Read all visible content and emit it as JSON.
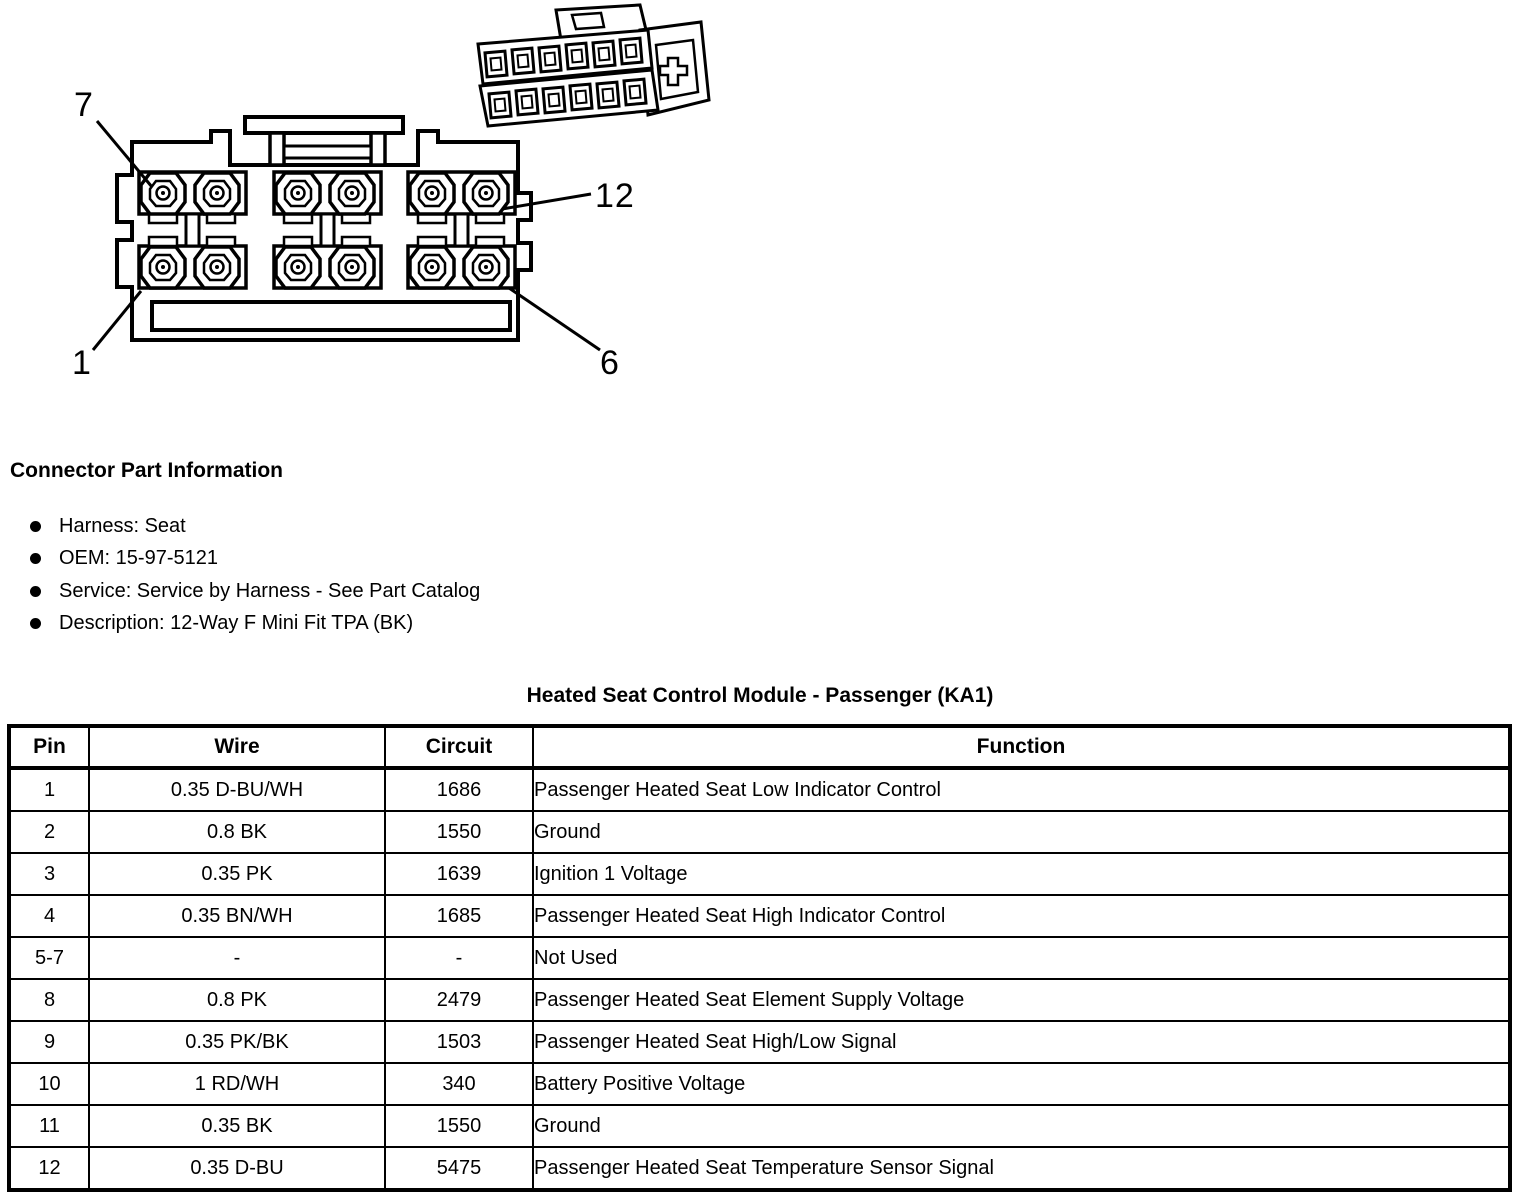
{
  "diagram": {
    "callouts": [
      {
        "id": "pin-7",
        "label": "7"
      },
      {
        "id": "pin-12",
        "label": "12"
      },
      {
        "id": "pin-1",
        "label": "1"
      },
      {
        "id": "pin-6",
        "label": "6"
      }
    ]
  },
  "section": {
    "title": "Connector Part Information",
    "bullets": [
      "Harness: Seat",
      "OEM: 15-97-5121",
      "Service: Service by Harness - See Part Catalog",
      "Description: 12-Way F Mini Fit TPA (BK)"
    ]
  },
  "table": {
    "title": "Heated Seat Control Module - Passenger (KA1)",
    "headers": [
      "Pin",
      "Wire",
      "Circuit",
      "Function"
    ],
    "rows": [
      [
        "1",
        "0.35 D-BU/WH",
        "1686",
        "Passenger Heated Seat Low Indicator Control"
      ],
      [
        "2",
        "0.8 BK",
        "1550",
        "Ground"
      ],
      [
        "3",
        "0.35 PK",
        "1639",
        "Ignition 1 Voltage"
      ],
      [
        "4",
        "0.35 BN/WH",
        "1685",
        "Passenger Heated Seat High Indicator Control"
      ],
      [
        "5-7",
        "-",
        "-",
        "Not Used"
      ],
      [
        "8",
        "0.8 PK",
        "2479",
        "Passenger Heated Seat Element Supply Voltage"
      ],
      [
        "9",
        "0.35 PK/BK",
        "1503",
        "Passenger Heated Seat High/Low Signal"
      ],
      [
        "10",
        "1 RD/WH",
        "340",
        "Battery Positive Voltage"
      ],
      [
        "11",
        "0.35 BK",
        "1550",
        "Ground"
      ],
      [
        "12",
        "0.35 D-BU",
        "5475",
        "Passenger Heated Seat Temperature Sensor Signal"
      ]
    ]
  },
  "colors": {
    "ink": "#000000",
    "paper": "#ffffff"
  }
}
